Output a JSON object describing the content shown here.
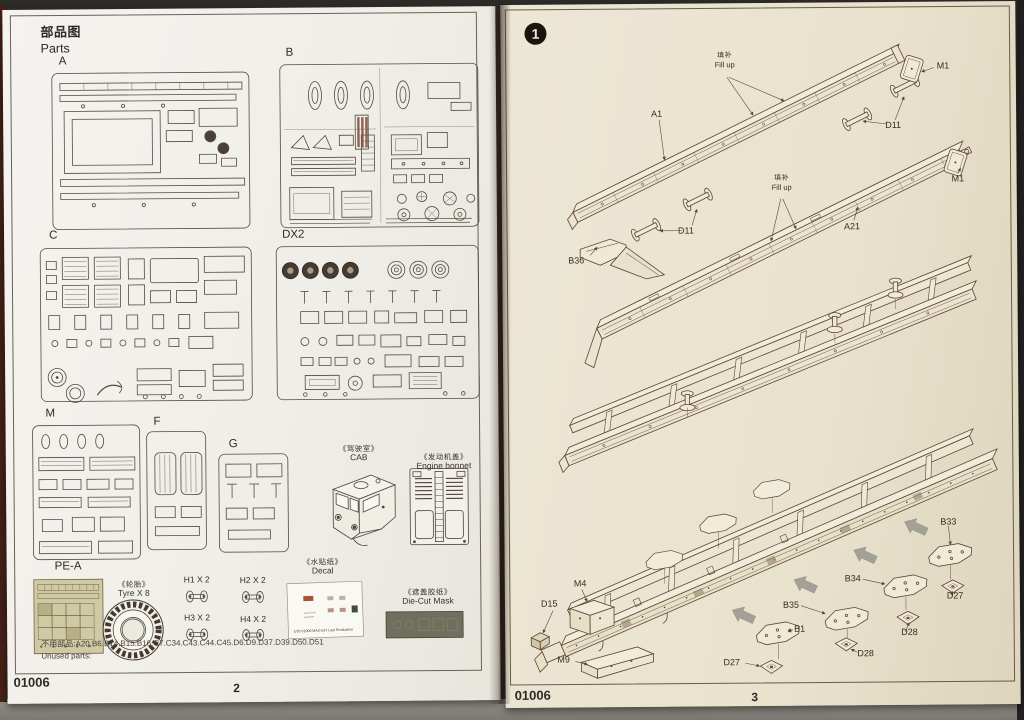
{
  "colors": {
    "left_paper": "#f1efe9",
    "right_paper": "#eae3cf",
    "line_art": "#5d4332",
    "mask_sheet": "#706e5c",
    "step_circle": "#18140f"
  },
  "left_page": {
    "title_cn": "部品图",
    "title_en": "Parts",
    "sprues": [
      {
        "label": "A"
      },
      {
        "label": "B"
      },
      {
        "label": "C"
      },
      {
        "label": "DX2"
      },
      {
        "label": "M"
      },
      {
        "label": "F"
      },
      {
        "label": "G"
      },
      {
        "label": "PE-A"
      }
    ],
    "tyre": {
      "label_cn": "《轮胎》",
      "label_en": "Tyre X 8"
    },
    "h_parts": [
      {
        "label": "H1 X 2"
      },
      {
        "label": "H2 X 2"
      },
      {
        "label": "H3 X 2"
      },
      {
        "label": "H4 X 2"
      }
    ],
    "decal": {
      "label_cn": "《水贴纸》",
      "label_en": "Decal",
      "sheet_text": "1/35  01006  MAZ-537 Last Production"
    },
    "die_cut_mask": {
      "label_cn": "《遮盖胶纸》",
      "label_en": "Die-Cut Mask"
    },
    "cab": {
      "label_cn": "《驾驶室》",
      "label_en": "CAB"
    },
    "engine_bonnet": {
      "label_cn": "《发动机盖》",
      "label_en": "Engine bonnet"
    },
    "unused_parts_cn": "不用部品:A20.B6.B14.B15.B16.C7.C34.C43.C44.C45.D6.D9.D37.D39.D50.D51",
    "unused_parts_en": "Unused parts:",
    "footer_code": "01006",
    "page_number": "2"
  },
  "right_page": {
    "step_number": "1",
    "callouts": [
      {
        "id": "fill-up-upper",
        "cn": "填补",
        "en": "Fill up"
      },
      {
        "id": "m1-upper",
        "text": "M1"
      },
      {
        "id": "a1",
        "text": "A1"
      },
      {
        "id": "d11-upper",
        "text": "D11"
      },
      {
        "id": "m1-lower",
        "text": "M1"
      },
      {
        "id": "fill-up-lower",
        "cn": "填补",
        "en": "Fill up"
      },
      {
        "id": "a21",
        "text": "A21"
      },
      {
        "id": "d11-lower",
        "text": "D11"
      },
      {
        "id": "b36",
        "text": "B36"
      },
      {
        "id": "m4",
        "text": "M4"
      },
      {
        "id": "d15",
        "text": "D15"
      },
      {
        "id": "m9",
        "text": "M9"
      },
      {
        "id": "b1",
        "text": "B1"
      },
      {
        "id": "b35",
        "text": "B35"
      },
      {
        "id": "b34",
        "text": "B34"
      },
      {
        "id": "b33",
        "text": "B33"
      },
      {
        "id": "d27-front",
        "text": "D27"
      },
      {
        "id": "d28-front",
        "text": "D28"
      },
      {
        "id": "d28-rear",
        "text": "D28"
      },
      {
        "id": "d27-rear",
        "text": "D27"
      }
    ],
    "footer_code": "01006",
    "page_number": "3"
  }
}
